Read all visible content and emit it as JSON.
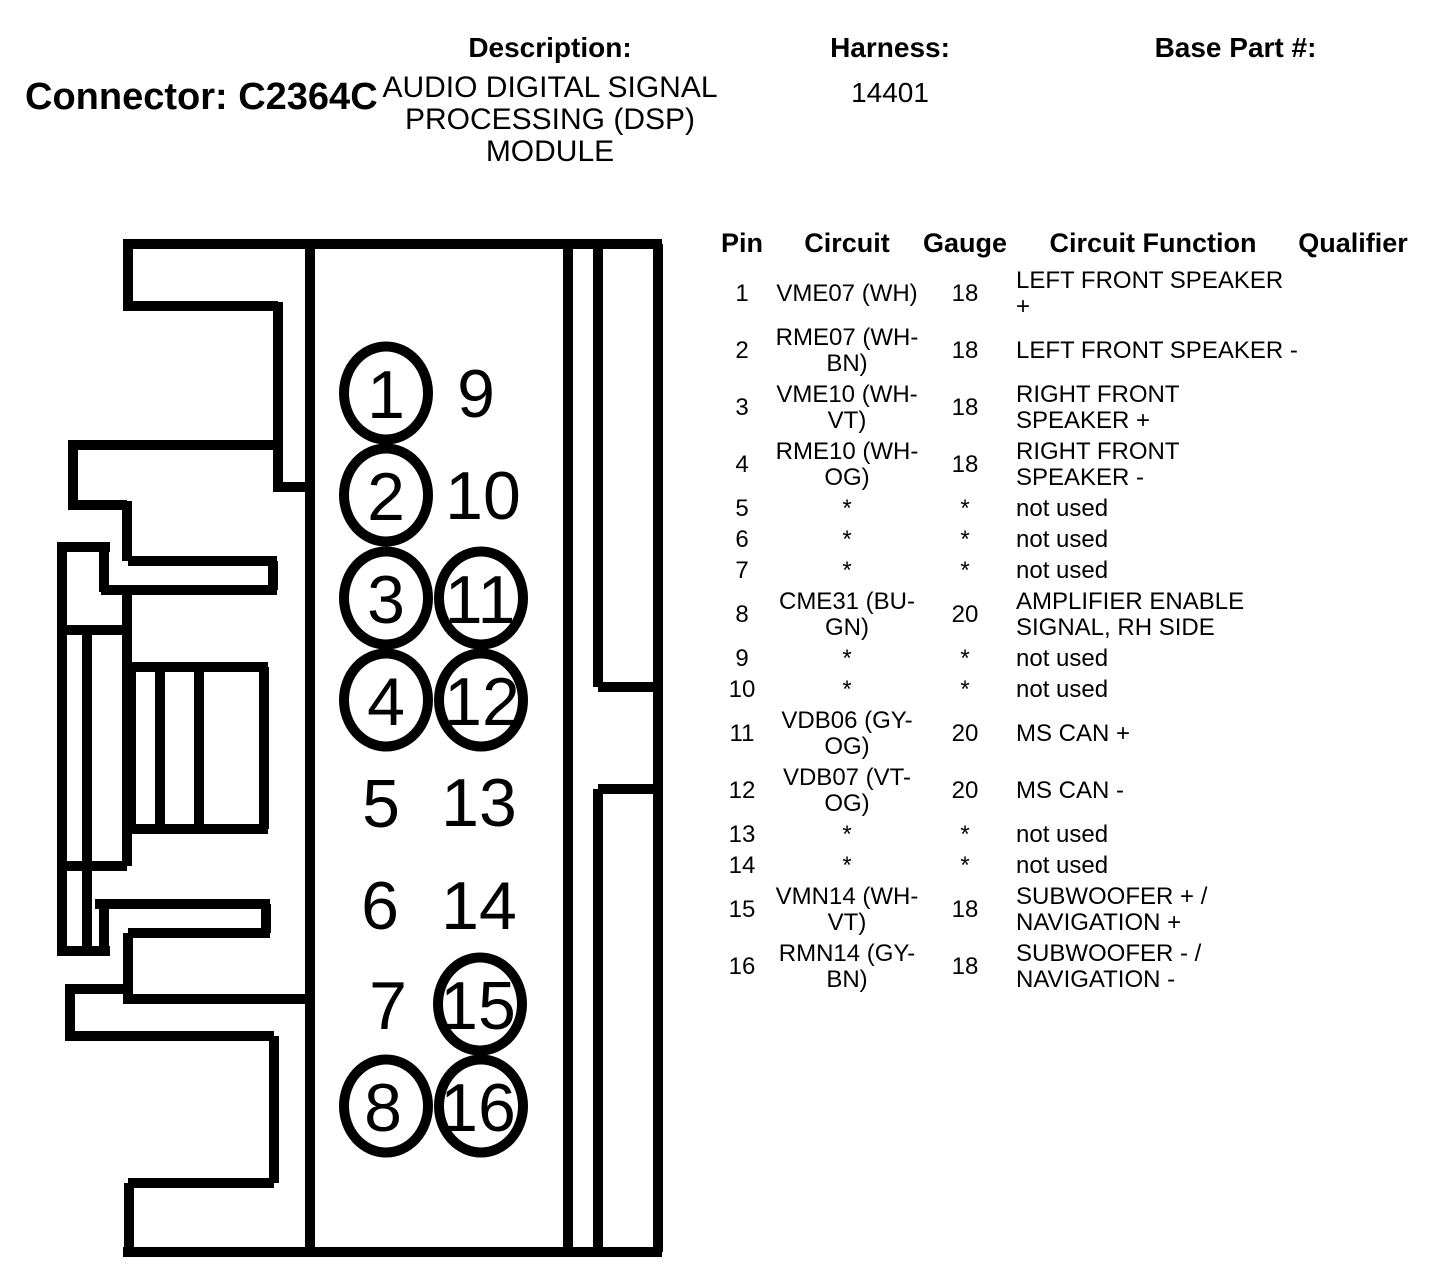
{
  "header": {
    "connector_label": "Connector: C2364C",
    "description_label": "Description:",
    "description_value": "AUDIO DIGITAL SIGNAL\nPROCESSING (DSP)\nMODULE",
    "harness_label": "Harness:",
    "harness_value": "14401",
    "base_part_label": "Base Part #:",
    "base_part_value": ""
  },
  "diagram": {
    "pins": [
      {
        "number": "1",
        "circled": true
      },
      {
        "number": "2",
        "circled": true
      },
      {
        "number": "3",
        "circled": true
      },
      {
        "number": "4",
        "circled": true
      },
      {
        "number": "5",
        "circled": false
      },
      {
        "number": "6",
        "circled": false
      },
      {
        "number": "7",
        "circled": false
      },
      {
        "number": "8",
        "circled": true
      },
      {
        "number": "9",
        "circled": false
      },
      {
        "number": "10",
        "circled": false
      },
      {
        "number": "11",
        "circled": true
      },
      {
        "number": "12",
        "circled": true
      },
      {
        "number": "13",
        "circled": false
      },
      {
        "number": "14",
        "circled": false
      },
      {
        "number": "15",
        "circled": true
      },
      {
        "number": "16",
        "circled": true
      }
    ]
  },
  "pin_table": {
    "columns": [
      "Pin",
      "Circuit",
      "Gauge",
      "Circuit Function",
      "Qualifier"
    ],
    "rows": [
      {
        "pin": "1",
        "circuit": "VME07 (WH)",
        "gauge": "18",
        "function": "LEFT FRONT SPEAKER +",
        "qualifier": ""
      },
      {
        "pin": "2",
        "circuit": "RME07 (WH-\nBN)",
        "gauge": "18",
        "function": "LEFT FRONT SPEAKER -",
        "qualifier": ""
      },
      {
        "pin": "3",
        "circuit": "VME10 (WH-\nVT)",
        "gauge": "18",
        "function": "RIGHT FRONT SPEAKER +",
        "qualifier": ""
      },
      {
        "pin": "4",
        "circuit": "RME10 (WH-\nOG)",
        "gauge": "18",
        "function": "RIGHT FRONT SPEAKER -",
        "qualifier": ""
      },
      {
        "pin": "5",
        "circuit": "*",
        "gauge": "*",
        "function": "not used",
        "qualifier": ""
      },
      {
        "pin": "6",
        "circuit": "*",
        "gauge": "*",
        "function": "not used",
        "qualifier": ""
      },
      {
        "pin": "7",
        "circuit": "*",
        "gauge": "*",
        "function": "not used",
        "qualifier": ""
      },
      {
        "pin": "8",
        "circuit": "CME31 (BU-\nGN)",
        "gauge": "20",
        "function": "AMPLIFIER ENABLE\nSIGNAL, RH SIDE",
        "qualifier": ""
      },
      {
        "pin": "9",
        "circuit": "*",
        "gauge": "*",
        "function": "not used",
        "qualifier": ""
      },
      {
        "pin": "10",
        "circuit": "*",
        "gauge": "*",
        "function": "not used",
        "qualifier": ""
      },
      {
        "pin": "11",
        "circuit": "VDB06 (GY-\nOG)",
        "gauge": "20",
        "function": "MS CAN +",
        "qualifier": ""
      },
      {
        "pin": "12",
        "circuit": "VDB07 (VT-\nOG)",
        "gauge": "20",
        "function": "MS CAN -",
        "qualifier": ""
      },
      {
        "pin": "13",
        "circuit": "*",
        "gauge": "*",
        "function": "not used",
        "qualifier": ""
      },
      {
        "pin": "14",
        "circuit": "*",
        "gauge": "*",
        "function": "not used",
        "qualifier": ""
      },
      {
        "pin": "15",
        "circuit": "VMN14 (WH-\nVT)",
        "gauge": "18",
        "function": "SUBWOOFER + /\nNAVIGATION +",
        "qualifier": ""
      },
      {
        "pin": "16",
        "circuit": "RMN14 (GY-\nBN)",
        "gauge": "18",
        "function": "SUBWOOFER - /\nNAVIGATION -",
        "qualifier": ""
      }
    ]
  }
}
